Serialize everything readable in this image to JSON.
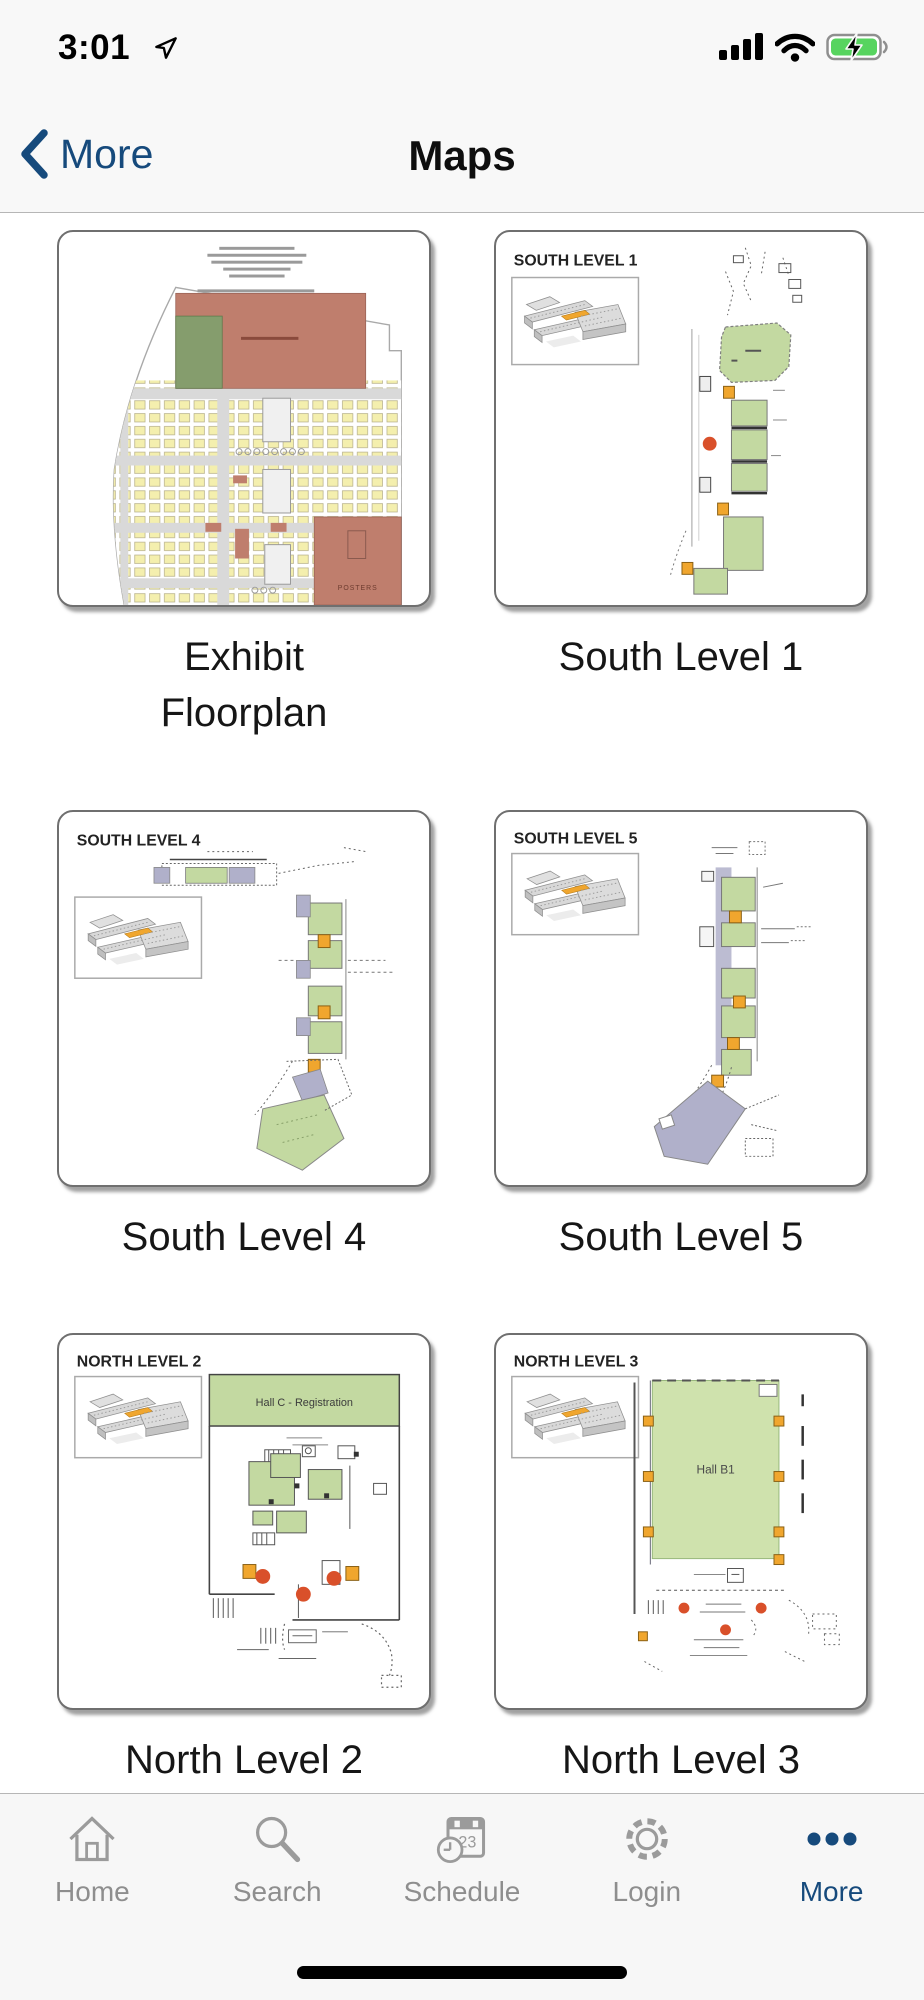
{
  "status_bar": {
    "time": "3:01"
  },
  "nav_bar": {
    "back_label": "More",
    "title": "Maps"
  },
  "maps": {
    "items": [
      {
        "label": "Exhibit\nFloorplan",
        "map_texts": {
          "posters": "POSTERS"
        }
      },
      {
        "label": "South Level 1",
        "map_title": "SOUTH LEVEL 1"
      },
      {
        "label": "South Level 4",
        "map_title": "SOUTH LEVEL 4"
      },
      {
        "label": "South Level 5",
        "map_title": "SOUTH LEVEL 5"
      },
      {
        "label": "North Level 2",
        "map_title": "NORTH LEVEL 2",
        "hall_label": "Hall C - Registration"
      },
      {
        "label": "North Level 3",
        "map_title": "NORTH LEVEL 3",
        "hall_label": "Hall B1"
      }
    ]
  },
  "tab_bar": {
    "active_tab": "More",
    "tabs": [
      {
        "label": "Home"
      },
      {
        "label": "Search"
      },
      {
        "label": "Schedule",
        "badge_day": "23"
      },
      {
        "label": "Login"
      },
      {
        "label": "More"
      }
    ]
  },
  "colors": {
    "accent_navy": "#164a7c",
    "tab_inactive": "#8e8e8e",
    "hall_green": "#c3d9a1",
    "big_hall_green": "#cfe2ad",
    "booth_yellow": "#f4efae",
    "plan_red": "#bf7e6d",
    "dark_green": "#859d6d",
    "lavender": "#b0b0ca",
    "marker_orange": "#f0a62e",
    "marker_red": "#d9502a",
    "battery_green": "#57d45f"
  }
}
